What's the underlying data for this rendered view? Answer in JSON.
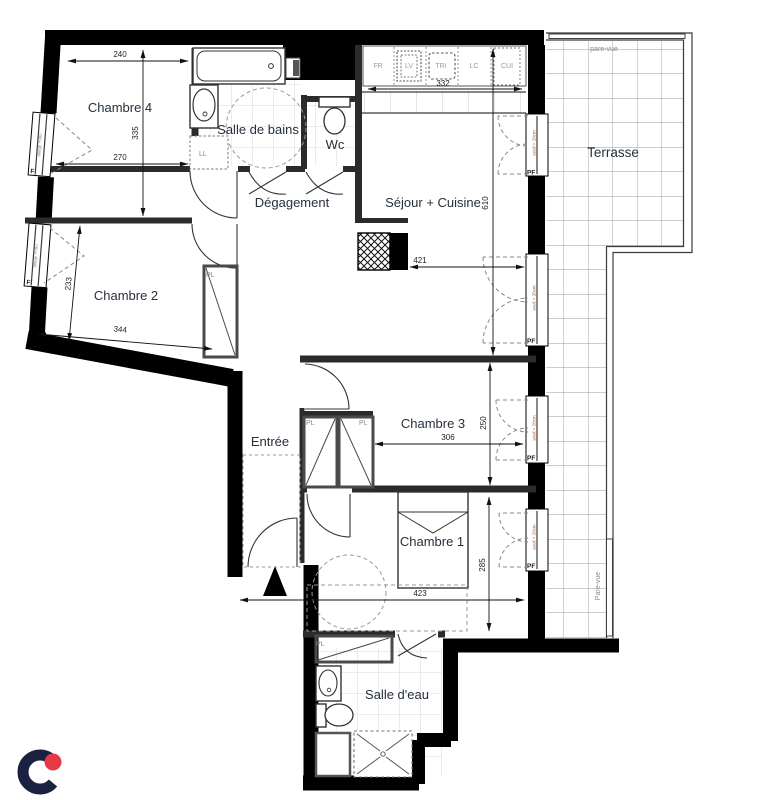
{
  "plan": {
    "rooms": {
      "chambre4": "Chambre 4",
      "salle_de_bains": "Salle de bains",
      "wc": "Wc",
      "degagement": "Dégagement",
      "sejour": "Séjour + Cuisine",
      "terrasse": "Terrasse",
      "chambre2": "Chambre 2",
      "entree": "Entrée",
      "chambre3": "Chambre 3",
      "chambre1": "Chambre 1",
      "salle_deau": "Salle d'eau"
    },
    "dims": {
      "d240": "240",
      "d335": "335",
      "d270": "270",
      "d332": "332",
      "d610": "610",
      "d421": "421",
      "d233": "233",
      "d344": "344",
      "d306": "306",
      "d250": "250",
      "d423": "423",
      "d285": "285"
    },
    "annotations": {
      "pf": "PF",
      "pl": "PL",
      "f": "F",
      "ll": "LL",
      "seuil": "seuil < 20cm",
      "allege": "allège +090",
      "pare_vue": "pare-vue",
      "pare_vue_cap": "Pare-vue"
    },
    "kitchen": {
      "items": [
        "FR",
        "LV",
        "TRI",
        "LC",
        "CUI"
      ]
    },
    "colors": {
      "wall": "#000000",
      "room_label": "#26303c",
      "seuil_text": "#b4652a",
      "logo_navy": "#1b2140",
      "logo_red": "#e63946"
    }
  }
}
